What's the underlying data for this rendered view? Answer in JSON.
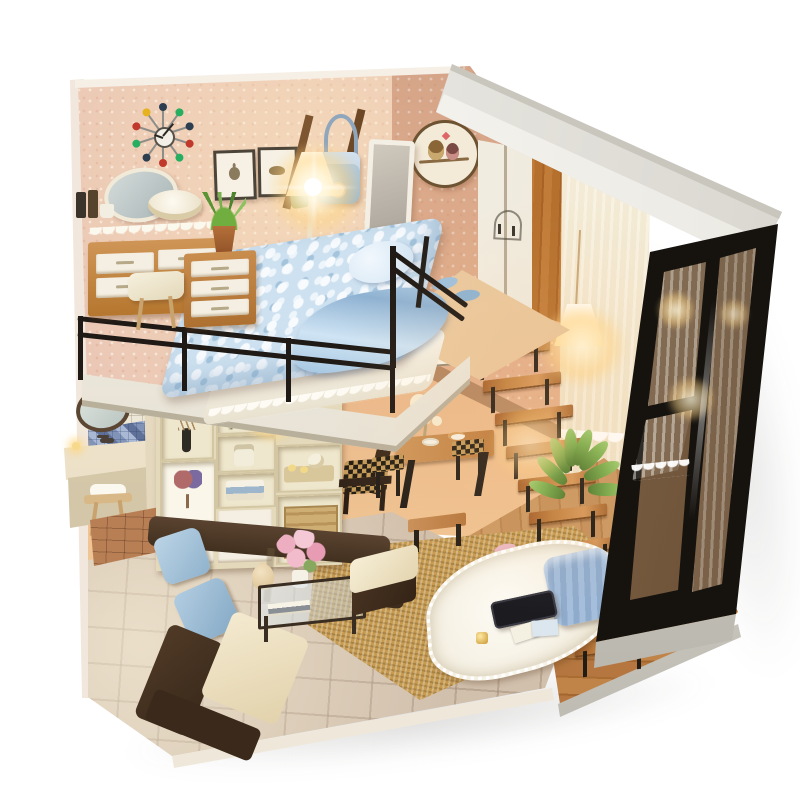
{
  "scene": {
    "subject": "diy-miniature-dollhouse-loft-apartment",
    "style": "product-photo-on-white",
    "background": "#ffffff"
  },
  "palette": {
    "wall_pink": "#e8c3b4",
    "wall_warm": "#e0a87f",
    "roof_white": "#f0efeb",
    "frame_black": "#1d1915",
    "wood_warm": "#bf7a3e",
    "wood_dark": "#8a5526",
    "leather_brown": "#46311f",
    "cushion_cream": "#f0e4c6",
    "pillow_blue": "#a9c6dd",
    "blanket_blue": "#cde1f0",
    "rug_tan": "#c69a4f",
    "tile_floor": "#c7b5a2",
    "bathroom_tile": "#ede7d8",
    "mosaic_blue": "#7e90b4",
    "curtain_cream": "#f4ecd9",
    "glass_warm": "#e3c9a4",
    "lamp_glow": "#ffd98b",
    "trim_silver": "#d6d3cb",
    "terracotta_floor": "#b97f54",
    "shelf_cream": "#e4d9ba",
    "plant_green": "#6a9c44"
  },
  "counts": {
    "stair_steps": 10,
    "railing_posts": 4,
    "clock_spokes": 10,
    "plant_leaves": 8
  },
  "clock": {
    "dot_colors": [
      "#c0392b",
      "#2c3e50",
      "#27ae60",
      "#c0392b",
      "#e6b220",
      "#2c3e50",
      "#27ae60",
      "#2c3e50",
      "#c0392b",
      "#27ae60"
    ]
  },
  "objects": {
    "roof": "white roof slab",
    "pink_wall": "speckled pink bedroom wall",
    "sunburst_clock": "sunburst wall clock",
    "picture_frames": "two framed sketches",
    "wall_rack_bag": "wall rack with blue shoulder bag",
    "floor_lamp": "glowing floor lamp",
    "owl_decal": "round owl-couple wall decal",
    "wardrobe": "white wardrobe with wood side panel",
    "standing_mirror": "white full-length mirror",
    "loft_bed": "loft bed with blue pebble blanket",
    "railing": "black loft railing",
    "vanity_dresser": "wooden dresser with white drawers",
    "vanity_mirror": "oval vanity mirror",
    "loft_stool": "cream stool",
    "blue_slippers": "blue slippers",
    "bathroom": "bathroom nook with sink, round mirror, mosaic band, stool",
    "shelf_unit": "cream cubby shelf with heart-tree poster and tea tray",
    "armchair": "dark armchair with checkered seat",
    "dining_set": "wooden dining table with checkered benches",
    "stairs": "open wooden staircase",
    "plant": "green leafy plant",
    "pendant_lamp": "glowing white pendant lamp",
    "sheer_curtain": "cream sheer curtain with lace hem",
    "glass_wall": "black-framed glass corner wall",
    "platform": "raised wooden tatami platform",
    "white_blanket": "white pompom blanket",
    "blue_cushion": "blue knit cushion",
    "phone": "black phone",
    "pink_slippers": "pink slippers",
    "sofa": "brown leather sofa with cream cushions and blue pillows",
    "coffee_table": "glass coffee table with pink roses and teddy bear",
    "ottoman": "brown ottoman with cream top",
    "rug": "woven tan rug",
    "tile_floor": "beige tiled floor",
    "silver_trim": "silver base trim"
  }
}
